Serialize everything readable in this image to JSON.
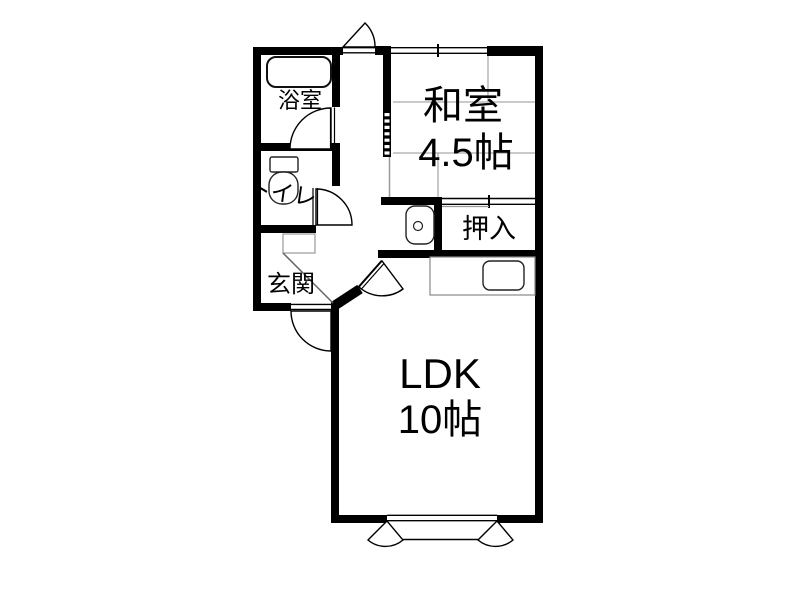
{
  "plan": {
    "title": "1LDK apartment floor plan",
    "rooms": {
      "bathroom": {
        "label": "浴室"
      },
      "toilet": {
        "label": "トイレ"
      },
      "entrance": {
        "label": "玄関"
      },
      "japanese_room": {
        "label": "和室",
        "size": "4.5帖"
      },
      "closet": {
        "label": "押入"
      },
      "ldk": {
        "label": "LDK",
        "size": "10帖"
      }
    },
    "fixtures": [
      {
        "name": "bathtub-icon"
      },
      {
        "name": "toilet-bowl-icon"
      },
      {
        "name": "washing-machine-pan-icon"
      },
      {
        "name": "kitchen-counter-icon"
      },
      {
        "name": "kitchen-sink-icon"
      },
      {
        "name": "shoe-cabinet-icon"
      },
      {
        "name": "entrance-step-line"
      }
    ],
    "colors": {
      "wall": "#000000",
      "background": "#ffffff",
      "fixture_outline": "#222222",
      "counter_outline": "#888888",
      "tatami_line": "#aaaaaa",
      "step_line": "#666666"
    }
  }
}
